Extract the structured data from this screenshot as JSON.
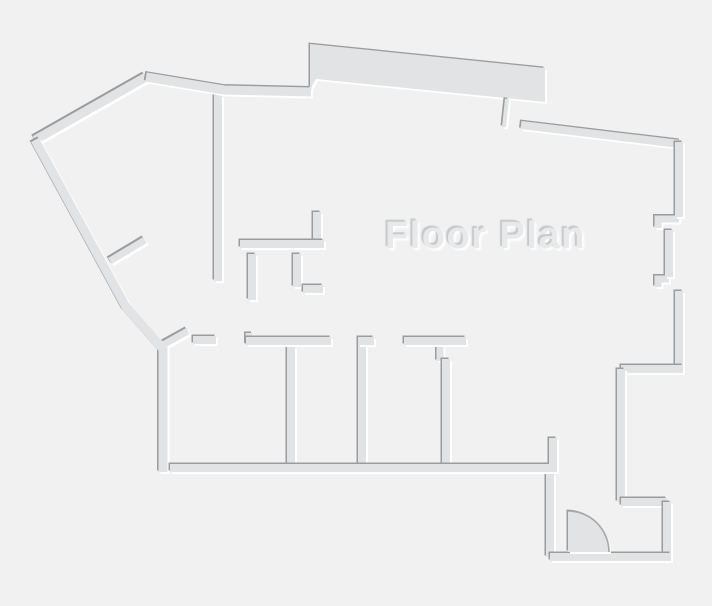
{
  "title": "Floor Plan",
  "colors": {
    "background": "#f1f1f2",
    "wall_fill": "#e2e3e4",
    "edge_shadow": "#9b9c9d",
    "edge_highlight": "#ffffff",
    "title_fill": "#e8e9ea",
    "title_shadow": "#c6c8c9",
    "door_arc": "#a6a7a8"
  },
  "floorplan": {
    "walls": [
      {
        "name": "interior-wall-vertical-center",
        "d": "M218,95 L218,281"
      },
      {
        "name": "closet-stub-up",
        "d": "M317,240 L317,212"
      },
      {
        "name": "closet-stub-down-left",
        "d": "M252,254 L252,300"
      },
      {
        "name": "closet-stub-down-right",
        "d": "M297,254 L297,287"
      },
      {
        "name": "closet-foot",
        "d": "M303,289 L323,289"
      },
      {
        "name": "closet-wall-horizontal",
        "d": "M240,244 L324,244"
      },
      {
        "name": "left-perpendicular-stub",
        "d": "M110,261 L145,240",
        "w": 7
      },
      {
        "name": "door-leaf-lower-left",
        "d": "M161,346 L188,331",
        "w": 7
      },
      {
        "name": "room-divider-1",
        "d": "M291,347 L291,465"
      },
      {
        "name": "room-divider-2",
        "d": "M362,345 L362,465"
      },
      {
        "name": "room-divider-3-stub",
        "d": "M440,345 L440,361",
        "w": 7
      },
      {
        "name": "room-divider-3",
        "d": "M446,359 L446,465"
      },
      {
        "name": "header-wall-left",
        "d": "M193,340 L216,340"
      },
      {
        "name": "header-wall-notch",
        "d": "M249,333 L249,344",
        "w": 7
      },
      {
        "name": "header-wall-1",
        "d": "M246,341 L331,341"
      },
      {
        "name": "header-wall-2",
        "d": "M358,341 L374,341"
      },
      {
        "name": "header-wall-3",
        "d": "M404,341 L466,341"
      },
      {
        "name": "right-wall-jamb-upper",
        "d": "M679,219 L658,219 L658,228",
        "w": 7
      },
      {
        "name": "right-wall-jamb-lower",
        "d": "M658,287 L658,279 L669,279",
        "w": 7
      },
      {
        "name": "right-wall-recessed",
        "d": "M669,230 L669,277"
      },
      {
        "name": "bump-wall-top",
        "type": "fill",
        "d": "M310,44 L545,68 L545,102 L316,79 L310,90 Z"
      },
      {
        "name": "bump-slit-wall",
        "d": "M507,99 L504,127",
        "w": 4
      },
      {
        "name": "exterior-wall-top-left-diagonal",
        "d": "M146,77 L35,140",
        "w": 9
      },
      {
        "name": "exterior-wall-left",
        "d": "M35,140 L126,307 L163,349 L163,472",
        "w": 9
      },
      {
        "name": "exterior-wall-top",
        "d": "M146,77 L224,90 L311,92",
        "w": 9
      },
      {
        "name": "exterior-wall-top-right",
        "d": "M521,125 L680,144"
      },
      {
        "name": "exterior-wall-right-upper",
        "d": "M679,142 L679,217"
      },
      {
        "name": "exterior-wall-right-lower",
        "d": "M679,291 L679,371"
      },
      {
        "name": "step-wall-top",
        "d": "M683,369 L621,369"
      },
      {
        "name": "step-wall-left",
        "d": "M621,369 L621,502"
      },
      {
        "name": "step-wall-bottom",
        "d": "M621,502 L667,502"
      },
      {
        "name": "step-wall-right",
        "d": "M667,502 L667,559"
      },
      {
        "name": "entry-wall-left",
        "d": "M550,474 L550,557"
      },
      {
        "name": "entry-wall-bottom",
        "d": "M550,557 L671,557"
      },
      {
        "name": "exterior-wall-bottom",
        "d": "M170,468 L553,468 L553,438"
      }
    ],
    "door": {
      "pie": "M568,552 L568,511 A41,41 0 0 1 609,552 Z",
      "arc": "M568,511 A41,41 0 0 1 609,552"
    }
  }
}
